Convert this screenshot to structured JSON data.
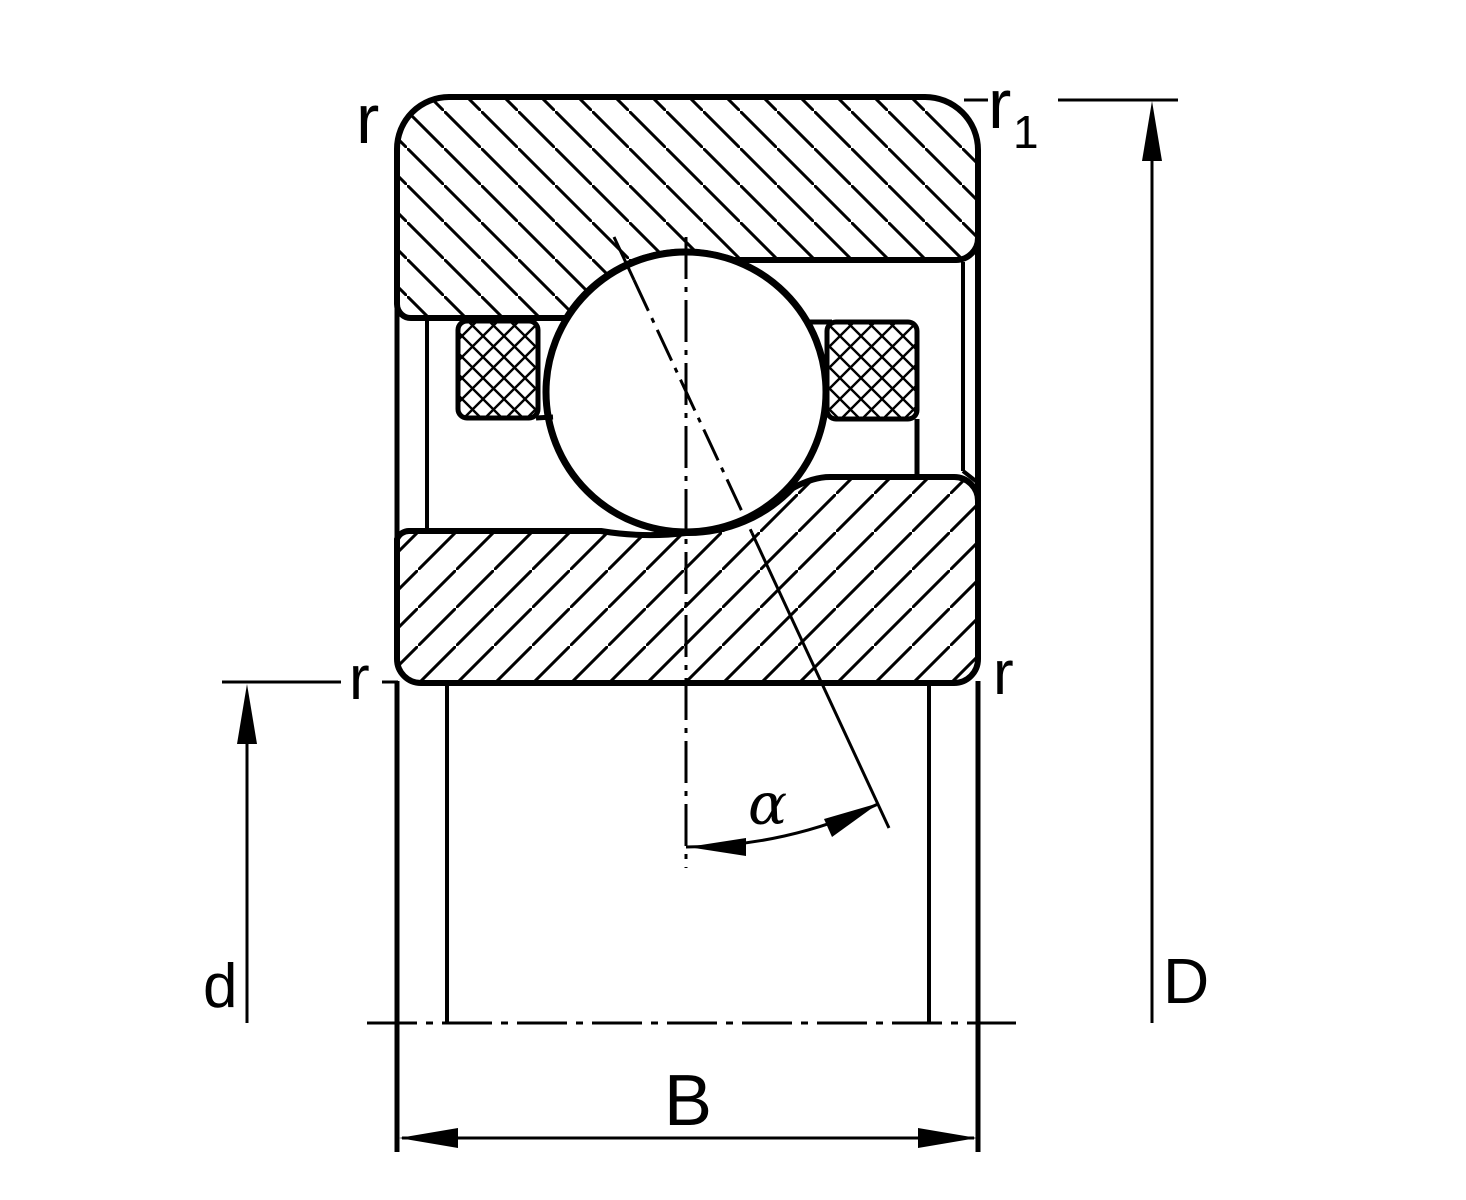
{
  "drawing": {
    "labels": {
      "r_top_left": "r",
      "r1_base": "r",
      "r1_sub": "1",
      "r_mid_left": "r",
      "r_mid_right": "r",
      "bore_diameter": "d",
      "outside_diameter": "D",
      "width": "B",
      "contact_angle": "α"
    },
    "colors": {
      "line": "#000000",
      "background": "#ffffff"
    }
  }
}
